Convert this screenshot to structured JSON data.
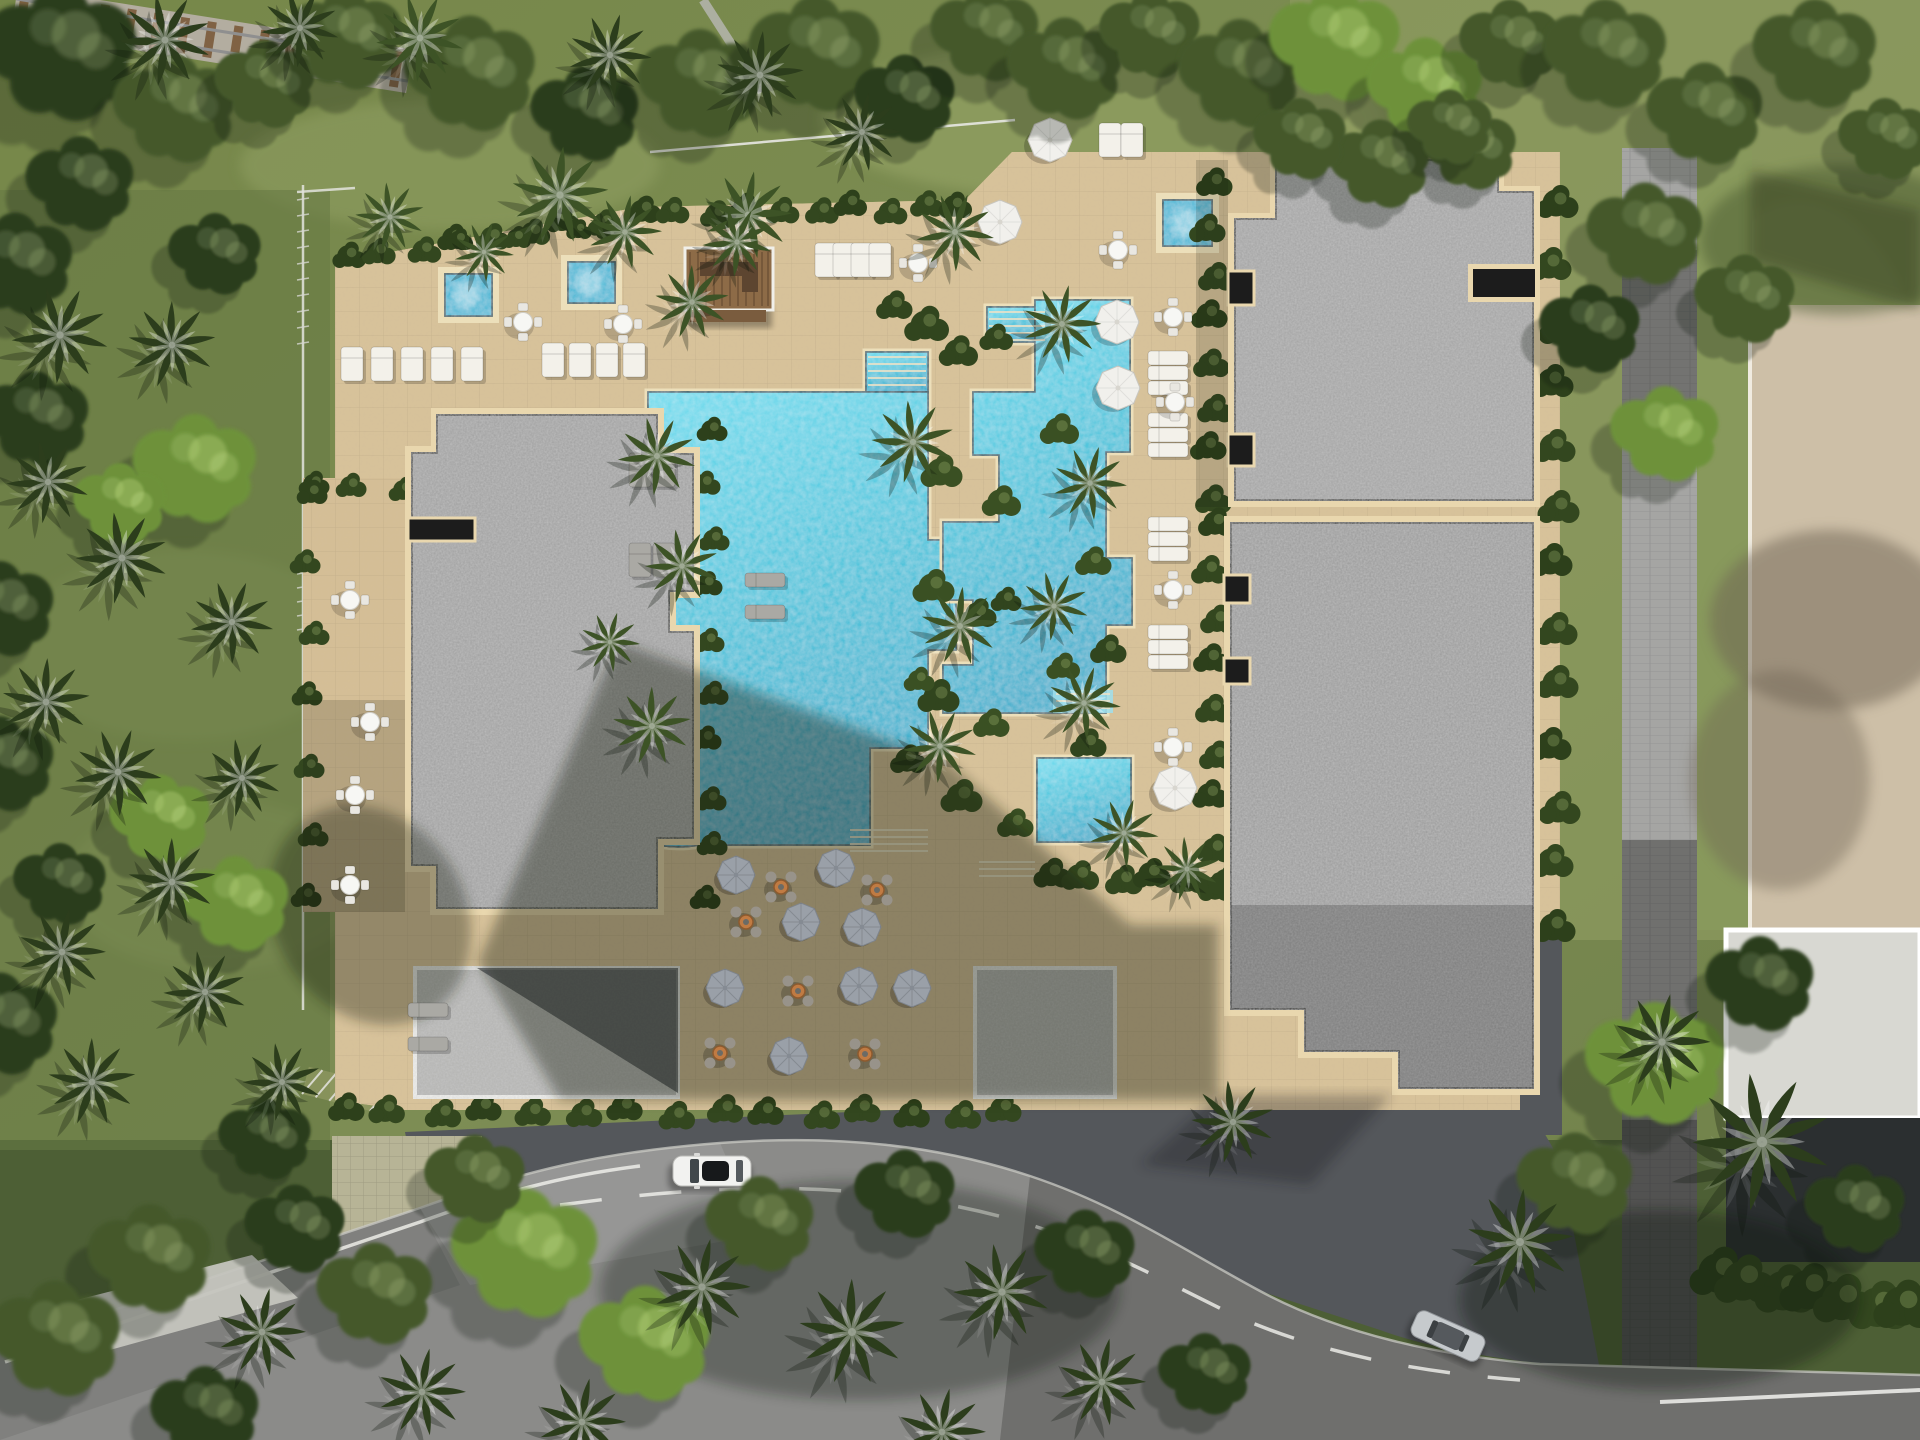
{
  "meta": {
    "description": "aerial-top-down-render-of-resort-site-with-pools-roofs-road",
    "canvas": {
      "w": 1920,
      "h": 1440
    }
  },
  "colors": {
    "grass_base": "#7c8c53",
    "grass_light": "#93a164",
    "grass_dark": "#5c6e3e",
    "forest_dark": "#2c3e1f",
    "canopy": "#44582b",
    "canopy_bright": "#6d8844",
    "palm": "#3d5326",
    "palm_dark": "#2c3d1c",
    "bush": "#33471f",
    "deck": "#d8c299",
    "deck_shade": "#8a7c66",
    "tile_line": "#00000014",
    "water_hi": "#66dcee",
    "water_lo": "#28a8c8",
    "water_edge": "#1d4f5e",
    "coping": "#ecdfba",
    "roof": "#9c9c9c",
    "roof_light": "#b5b5b3",
    "roof_dark": "#8e8e8e",
    "parapet": "#e9d7ae",
    "roof_slot": "#1c1c1c",
    "annex_border": "#f2f2ef",
    "road": "#8b8b89",
    "plaza": "#54575b",
    "paver_path": "#a5a5a3",
    "sidewalk": "#c5c5bf",
    "driveway": "#b7b496",
    "marking": "#f2f2ee",
    "neighbor_roof": "#cdbfa7",
    "neighbor_roof2": "#d8d8d2",
    "neighbor_dark": "#2b2f30",
    "rail_gravel": "#b3ada0",
    "rail_tie": "#7a5a3a",
    "fence": "#e3e4de",
    "umbrella_white": "#f1f0ec",
    "umbrella_gray": "#9aa0a8",
    "lounger": "#f3f1ea",
    "table_white": "#f7f7f4",
    "table_orange": "#c07b43",
    "car_white": "#f2f2f0",
    "car_silver": "#c6cacd",
    "wood": "#8d6b47"
  },
  "scene": {
    "palms": [
      {
        "x": 165,
        "y": 40,
        "s": 1.0,
        "v": "d"
      },
      {
        "x": 300,
        "y": 28,
        "s": 0.85,
        "v": "d"
      },
      {
        "x": 420,
        "y": 38,
        "s": 0.95,
        "v": "n"
      },
      {
        "x": 610,
        "y": 55,
        "s": 0.9,
        "v": "d"
      },
      {
        "x": 760,
        "y": 75,
        "s": 0.95,
        "v": "d"
      },
      {
        "x": 560,
        "y": 195,
        "s": 1.05,
        "v": "n"
      },
      {
        "x": 625,
        "y": 232,
        "s": 0.8,
        "v": "n"
      },
      {
        "x": 748,
        "y": 215,
        "s": 0.95,
        "v": "n"
      },
      {
        "x": 955,
        "y": 232,
        "s": 0.85,
        "v": "n"
      },
      {
        "x": 862,
        "y": 132,
        "s": 0.85,
        "v": "d"
      },
      {
        "x": 60,
        "y": 335,
        "s": 1.05,
        "v": "d"
      },
      {
        "x": 172,
        "y": 345,
        "s": 0.95,
        "v": "d"
      },
      {
        "x": 48,
        "y": 482,
        "s": 0.9,
        "v": "d"
      },
      {
        "x": 122,
        "y": 558,
        "s": 1.0,
        "v": "d"
      },
      {
        "x": 232,
        "y": 622,
        "s": 0.9,
        "v": "d"
      },
      {
        "x": 46,
        "y": 702,
        "s": 0.95,
        "v": "d"
      },
      {
        "x": 118,
        "y": 772,
        "s": 0.95,
        "v": "d"
      },
      {
        "x": 242,
        "y": 778,
        "s": 0.85,
        "v": "d"
      },
      {
        "x": 172,
        "y": 882,
        "s": 0.95,
        "v": "d"
      },
      {
        "x": 62,
        "y": 952,
        "s": 0.95,
        "v": "d"
      },
      {
        "x": 205,
        "y": 992,
        "s": 0.9,
        "v": "d"
      },
      {
        "x": 92,
        "y": 1082,
        "s": 0.95,
        "v": "d"
      },
      {
        "x": 282,
        "y": 1082,
        "s": 0.85,
        "v": "d"
      },
      {
        "x": 692,
        "y": 302,
        "s": 0.8,
        "v": "n"
      },
      {
        "x": 657,
        "y": 456,
        "s": 0.85,
        "v": "n"
      },
      {
        "x": 682,
        "y": 566,
        "s": 0.8,
        "v": "n"
      },
      {
        "x": 652,
        "y": 726,
        "s": 0.85,
        "v": "n"
      },
      {
        "x": 610,
        "y": 642,
        "s": 0.65,
        "v": "n"
      },
      {
        "x": 913,
        "y": 442,
        "s": 0.9,
        "v": "n"
      },
      {
        "x": 960,
        "y": 626,
        "s": 0.85,
        "v": "n"
      },
      {
        "x": 940,
        "y": 746,
        "s": 0.8,
        "v": "n"
      },
      {
        "x": 1062,
        "y": 324,
        "s": 0.85,
        "v": "n"
      },
      {
        "x": 1090,
        "y": 483,
        "s": 0.8,
        "v": "n"
      },
      {
        "x": 1054,
        "y": 606,
        "s": 0.75,
        "v": "n"
      },
      {
        "x": 1084,
        "y": 703,
        "s": 0.8,
        "v": "n"
      },
      {
        "x": 1124,
        "y": 833,
        "s": 0.75,
        "v": "n"
      },
      {
        "x": 1187,
        "y": 869,
        "s": 0.7,
        "v": "n"
      },
      {
        "x": 737,
        "y": 242,
        "s": 0.75,
        "v": "n"
      },
      {
        "x": 484,
        "y": 252,
        "s": 0.65,
        "v": "n"
      },
      {
        "x": 390,
        "y": 217,
        "s": 0.75,
        "v": "n"
      },
      {
        "x": 1233,
        "y": 1122,
        "s": 0.9,
        "v": "d"
      },
      {
        "x": 1520,
        "y": 1242,
        "s": 1.15,
        "v": "d"
      },
      {
        "x": 1762,
        "y": 1142,
        "s": 1.5,
        "v": "d"
      },
      {
        "x": 1662,
        "y": 1042,
        "s": 1.05,
        "v": "d"
      },
      {
        "x": 702,
        "y": 1287,
        "s": 1.05,
        "v": "d"
      },
      {
        "x": 852,
        "y": 1332,
        "s": 1.15,
        "v": "d"
      },
      {
        "x": 1002,
        "y": 1292,
        "s": 1.05,
        "v": "d"
      },
      {
        "x": 1102,
        "y": 1382,
        "s": 0.95,
        "v": "d"
      },
      {
        "x": 422,
        "y": 1392,
        "s": 0.95,
        "v": "d"
      },
      {
        "x": 262,
        "y": 1332,
        "s": 0.95,
        "v": "d"
      },
      {
        "x": 582,
        "y": 1422,
        "s": 0.95,
        "v": "d"
      },
      {
        "x": 942,
        "y": 1432,
        "s": 0.95,
        "v": "d"
      }
    ],
    "trees": [
      {
        "x": 60,
        "y": 55,
        "s": 2.0,
        "v": "d"
      },
      {
        "x": 175,
        "y": 110,
        "s": 1.6,
        "v": "n"
      },
      {
        "x": 80,
        "y": 185,
        "s": 1.4,
        "v": "d"
      },
      {
        "x": 265,
        "y": 85,
        "s": 1.3,
        "v": "n"
      },
      {
        "x": 345,
        "y": 40,
        "s": 1.5,
        "v": "n"
      },
      {
        "x": 15,
        "y": 265,
        "s": 1.5,
        "v": "d"
      },
      {
        "x": 215,
        "y": 255,
        "s": 1.2,
        "v": "d"
      },
      {
        "x": 470,
        "y": 75,
        "s": 1.7,
        "v": "n"
      },
      {
        "x": 585,
        "y": 115,
        "s": 1.4,
        "v": "d"
      },
      {
        "x": 700,
        "y": 85,
        "s": 1.6,
        "v": "n"
      },
      {
        "x": 815,
        "y": 55,
        "s": 1.7,
        "v": "n"
      },
      {
        "x": 905,
        "y": 100,
        "s": 1.3,
        "v": "d"
      },
      {
        "x": 985,
        "y": 35,
        "s": 1.4,
        "v": "n"
      },
      {
        "x": 1065,
        "y": 70,
        "s": 1.5,
        "v": "n"
      },
      {
        "x": 1150,
        "y": 35,
        "s": 1.3,
        "v": "n"
      },
      {
        "x": 1240,
        "y": 75,
        "s": 1.6,
        "v": "n"
      },
      {
        "x": 1335,
        "y": 45,
        "s": 1.7,
        "v": "b"
      },
      {
        "x": 1425,
        "y": 90,
        "s": 1.5,
        "v": "b"
      },
      {
        "x": 1510,
        "y": 45,
        "s": 1.3,
        "v": "n"
      },
      {
        "x": 1470,
        "y": 150,
        "s": 1.2,
        "v": "n"
      },
      {
        "x": 1380,
        "y": 165,
        "s": 1.3,
        "v": "n"
      },
      {
        "x": 1605,
        "y": 55,
        "s": 1.6,
        "v": "n"
      },
      {
        "x": 1705,
        "y": 115,
        "s": 1.5,
        "v": "n"
      },
      {
        "x": 1815,
        "y": 55,
        "s": 1.6,
        "v": "n"
      },
      {
        "x": 1885,
        "y": 140,
        "s": 1.2,
        "v": "n"
      },
      {
        "x": 1645,
        "y": 235,
        "s": 1.5,
        "v": "n"
      },
      {
        "x": 1745,
        "y": 300,
        "s": 1.3,
        "v": "n"
      },
      {
        "x": 1590,
        "y": 330,
        "s": 1.3,
        "v": "d"
      },
      {
        "x": 1665,
        "y": 435,
        "s": 1.4,
        "v": "b"
      },
      {
        "x": 1655,
        "y": 1065,
        "s": 1.8,
        "v": "b"
      },
      {
        "x": 1575,
        "y": 1185,
        "s": 1.5,
        "v": "n"
      },
      {
        "x": 1760,
        "y": 985,
        "s": 1.4,
        "v": "d"
      },
      {
        "x": 1855,
        "y": 1210,
        "s": 1.3,
        "v": "d"
      },
      {
        "x": 525,
        "y": 1255,
        "s": 1.9,
        "v": "b"
      },
      {
        "x": 645,
        "y": 1345,
        "s": 1.7,
        "v": "b"
      },
      {
        "x": 760,
        "y": 1225,
        "s": 1.4,
        "v": "n"
      },
      {
        "x": 475,
        "y": 1180,
        "s": 1.3,
        "v": "n"
      },
      {
        "x": 375,
        "y": 1295,
        "s": 1.5,
        "v": "n"
      },
      {
        "x": 295,
        "y": 1230,
        "s": 1.3,
        "v": "d"
      },
      {
        "x": 150,
        "y": 1260,
        "s": 1.6,
        "v": "n"
      },
      {
        "x": 55,
        "y": 1340,
        "s": 1.7,
        "v": "n"
      },
      {
        "x": 205,
        "y": 1415,
        "s": 1.4,
        "v": "d"
      },
      {
        "x": 905,
        "y": 1195,
        "s": 1.3,
        "v": "d"
      },
      {
        "x": 1085,
        "y": 1255,
        "s": 1.3,
        "v": "d"
      },
      {
        "x": 1205,
        "y": 1375,
        "s": 1.2,
        "v": "d"
      },
      {
        "x": 35,
        "y": 420,
        "s": 1.4,
        "v": "d"
      },
      {
        "x": 195,
        "y": 470,
        "s": 1.6,
        "v": "b"
      },
      {
        "x": 120,
        "y": 505,
        "s": 1.2,
        "v": "b"
      },
      {
        "x": 0,
        "y": 610,
        "s": 1.4,
        "v": "d"
      },
      {
        "x": 0,
        "y": 765,
        "s": 1.4,
        "v": "d"
      },
      {
        "x": 160,
        "y": 820,
        "s": 1.3,
        "v": "b"
      },
      {
        "x": 235,
        "y": 905,
        "s": 1.4,
        "v": "b"
      },
      {
        "x": 60,
        "y": 885,
        "s": 1.2,
        "v": "d"
      },
      {
        "x": 0,
        "y": 1025,
        "s": 1.5,
        "v": "d"
      },
      {
        "x": 265,
        "y": 1140,
        "s": 1.2,
        "v": "d"
      },
      {
        "x": 1300,
        "y": 140,
        "s": 1.2,
        "v": "n"
      },
      {
        "x": 1450,
        "y": 128,
        "s": 1.1,
        "v": "n"
      }
    ],
    "umbrellas_white": [
      {
        "x": 1000,
        "y": 222
      },
      {
        "x": 1050,
        "y": 140
      },
      {
        "x": 1117,
        "y": 322
      },
      {
        "x": 1118,
        "y": 388
      },
      {
        "x": 1175,
        "y": 788
      }
    ],
    "umbrellas_gray": [
      {
        "x": 736,
        "y": 875
      },
      {
        "x": 836,
        "y": 868
      },
      {
        "x": 801,
        "y": 922
      },
      {
        "x": 862,
        "y": 927
      },
      {
        "x": 725,
        "y": 988
      },
      {
        "x": 859,
        "y": 986
      },
      {
        "x": 912,
        "y": 988
      },
      {
        "x": 789,
        "y": 1056
      }
    ],
    "tables_white": [
      {
        "x": 523,
        "y": 322
      },
      {
        "x": 623,
        "y": 324
      },
      {
        "x": 918,
        "y": 263
      },
      {
        "x": 1118,
        "y": 250
      },
      {
        "x": 1173,
        "y": 317
      },
      {
        "x": 1175,
        "y": 402
      },
      {
        "x": 1173,
        "y": 590
      },
      {
        "x": 1173,
        "y": 747
      },
      {
        "x": 350,
        "y": 600
      },
      {
        "x": 370,
        "y": 722
      },
      {
        "x": 355,
        "y": 795
      },
      {
        "x": 350,
        "y": 885
      }
    ],
    "tables_orange": [
      {
        "x": 781,
        "y": 887
      },
      {
        "x": 877,
        "y": 890
      },
      {
        "x": 746,
        "y": 922
      },
      {
        "x": 798,
        "y": 991
      },
      {
        "x": 720,
        "y": 1053
      },
      {
        "x": 865,
        "y": 1054
      }
    ],
    "lounger_rows": [
      {
        "x": 352,
        "y": 364,
        "n": 5,
        "dx": 30,
        "dy": 0,
        "kind": "v",
        "sh": 0
      },
      {
        "x": 553,
        "y": 360,
        "n": 4,
        "dx": 27,
        "dy": 0,
        "kind": "v",
        "sh": 0
      },
      {
        "x": 826,
        "y": 260,
        "n": 4,
        "dx": 18,
        "dy": 0,
        "kind": "v",
        "sh": 0
      },
      {
        "x": 1110,
        "y": 140,
        "n": 2,
        "dx": 22,
        "dy": 0,
        "kind": "v",
        "sh": 0
      },
      {
        "x": 1168,
        "y": 358,
        "n": 3,
        "dx": 0,
        "dy": 15,
        "kind": "h",
        "sh": 0
      },
      {
        "x": 1168,
        "y": 420,
        "n": 3,
        "dx": 0,
        "dy": 15,
        "kind": "h",
        "sh": 0
      },
      {
        "x": 1168,
        "y": 524,
        "n": 3,
        "dx": 0,
        "dy": 15,
        "kind": "h",
        "sh": 0
      },
      {
        "x": 1168,
        "y": 632,
        "n": 3,
        "dx": 0,
        "dy": 15,
        "kind": "h",
        "sh": 0
      },
      {
        "x": 640,
        "y": 470,
        "n": 2,
        "dx": 24,
        "dy": 0,
        "kind": "v",
        "sh": 1
      },
      {
        "x": 640,
        "y": 560,
        "n": 2,
        "dx": 24,
        "dy": 0,
        "kind": "v",
        "sh": 1
      },
      {
        "x": 765,
        "y": 580,
        "n": 2,
        "dx": 0,
        "dy": 32,
        "kind": "h",
        "sh": 1
      },
      {
        "x": 428,
        "y": 1010,
        "n": 2,
        "dx": 0,
        "dy": 34,
        "kind": "h",
        "sh": 1
      }
    ],
    "spas": [
      {
        "x": 445,
        "y": 274,
        "w": 47,
        "h": 42
      },
      {
        "x": 568,
        "y": 262,
        "w": 47,
        "h": 41
      },
      {
        "x": 1163,
        "y": 200,
        "w": 49,
        "h": 46
      }
    ],
    "stairs": [
      {
        "x": 868,
        "y": 357,
        "w": 58,
        "n": 5,
        "dy": 7
      },
      {
        "x": 989,
        "y": 312,
        "w": 56,
        "n": 5,
        "dy": 7
      },
      {
        "x": 850,
        "y": 830,
        "w": 78,
        "n": 4,
        "dy": 7
      },
      {
        "x": 979,
        "y": 862,
        "w": 56,
        "n": 3,
        "dy": 7
      },
      {
        "x": 558,
        "y": 692,
        "w": 46,
        "n": 4,
        "dy": 7
      },
      {
        "x": 1056,
        "y": 694,
        "w": 54,
        "n": 3,
        "dy": 7
      }
    ],
    "bush_bands": [
      {
        "x1": 345,
        "y1": 258,
        "x2": 638,
        "y2": 213,
        "n": 9,
        "s": 1.2
      },
      {
        "x1": 640,
        "y1": 212,
        "x2": 958,
        "y2": 206,
        "n": 10,
        "s": 1.2
      },
      {
        "x1": 1210,
        "y1": 185,
        "x2": 1210,
        "y2": 495,
        "n": 8,
        "s": 1.3
      },
      {
        "x1": 1212,
        "y1": 525,
        "x2": 1212,
        "y2": 890,
        "n": 9,
        "s": 1.3
      },
      {
        "x1": 708,
        "y1": 432,
        "x2": 708,
        "y2": 898,
        "n": 10,
        "s": 1.1
      },
      {
        "x1": 342,
        "y1": 1110,
        "x2": 1005,
        "y2": 1113,
        "n": 15,
        "s": 1.3
      },
      {
        "x1": 1048,
        "y1": 876,
        "x2": 1222,
        "y2": 878,
        "n": 6,
        "s": 1.35
      },
      {
        "x1": 310,
        "y1": 486,
        "x2": 398,
        "y2": 486,
        "n": 3,
        "s": 1.1
      },
      {
        "x1": 308,
        "y1": 495,
        "x2": 308,
        "y2": 900,
        "n": 7,
        "s": 1.1
      },
      {
        "x1": 1553,
        "y1": 205,
        "x2": 1553,
        "y2": 925,
        "n": 13,
        "s": 1.5
      },
      {
        "x1": 1715,
        "y1": 1275,
        "x2": 1905,
        "y2": 1310,
        "n": 7,
        "s": 2.2
      },
      {
        "x1": 455,
        "y1": 242,
        "x2": 520,
        "y2": 238,
        "n": 2,
        "s": 1.0
      },
      {
        "x1": 575,
        "y1": 232,
        "x2": 612,
        "y2": 230,
        "n": 2,
        "s": 0.9
      }
    ],
    "island_bushes": [
      {
        "x": 925,
        "y": 325,
        "s": 1.6
      },
      {
        "x": 957,
        "y": 352,
        "s": 1.4
      },
      {
        "x": 940,
        "y": 472,
        "s": 1.5
      },
      {
        "x": 1000,
        "y": 502,
        "s": 1.4
      },
      {
        "x": 932,
        "y": 587,
        "s": 1.5
      },
      {
        "x": 977,
        "y": 614,
        "s": 1.3
      },
      {
        "x": 937,
        "y": 697,
        "s": 1.5
      },
      {
        "x": 990,
        "y": 724,
        "s": 1.3
      },
      {
        "x": 960,
        "y": 797,
        "s": 1.5
      },
      {
        "x": 1014,
        "y": 824,
        "s": 1.3
      },
      {
        "x": 907,
        "y": 760,
        "s": 1.3
      },
      {
        "x": 1058,
        "y": 430,
        "s": 1.4
      },
      {
        "x": 1092,
        "y": 562,
        "s": 1.3
      },
      {
        "x": 1107,
        "y": 650,
        "s": 1.3
      },
      {
        "x": 1062,
        "y": 667,
        "s": 1.2
      },
      {
        "x": 1087,
        "y": 744,
        "s": 1.3
      },
      {
        "x": 893,
        "y": 306,
        "s": 1.3
      },
      {
        "x": 995,
        "y": 338,
        "s": 1.2
      },
      {
        "x": 918,
        "y": 680,
        "s": 1.1
      },
      {
        "x": 1005,
        "y": 600,
        "s": 1.1
      }
    ],
    "cars": [
      {
        "type": "suv_white",
        "x": 712,
        "y": 1171,
        "rot": 0
      },
      {
        "type": "sedan_silver",
        "x": 1448,
        "y": 1336,
        "rot": 24
      }
    ]
  }
}
